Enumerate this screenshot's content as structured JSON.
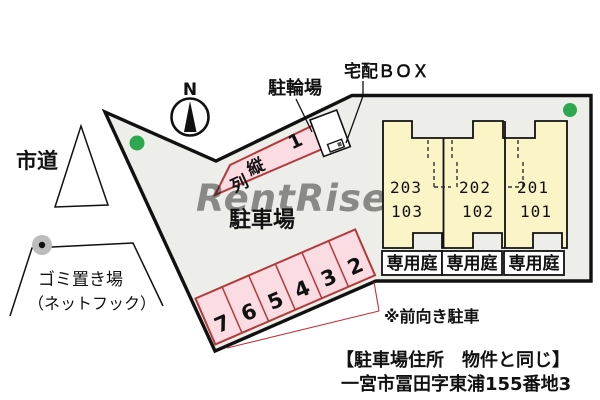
{
  "plan": {
    "compass": {
      "north": "N"
    },
    "labels": {
      "road": "市道",
      "bicycle_parking": "駐輪場",
      "delivery_box": "宅配ＢＯＸ",
      "parking_lot": "駐車場",
      "garbage_place": "ゴミ置き場",
      "garbage_note": "（ネットフック）",
      "front_facing_note": "※前向き駐車",
      "address_heading": "【駐車場住所　物件と同じ】",
      "address_line": "一宮市冨田字東浦155番地3",
      "watermark": "RentRise"
    },
    "parking": {
      "tandem": {
        "number": "1",
        "label": "縦列",
        "label_chars": [
          "縦",
          "列"
        ]
      },
      "stalls": [
        "7",
        "6",
        "5",
        "4",
        "3",
        "2"
      ]
    },
    "building": {
      "units": [
        {
          "unit_upper": "203",
          "unit_lower": "103",
          "garden": "専用庭"
        },
        {
          "unit_upper": "202",
          "unit_lower": "102",
          "garden": "専用庭"
        },
        {
          "unit_upper": "201",
          "unit_lower": "101",
          "garden": "専用庭"
        }
      ]
    },
    "colors": {
      "site_fill": "#EDEDEA",
      "boundary": "#111111",
      "stall_fill": "#FBDCE2",
      "stall_border": "#B23A3A",
      "unit_fill": "#FBF4C6",
      "note_red": "#CC1122",
      "green_marker": "#2EA84F",
      "pole_gray": "#BCBCBC"
    }
  }
}
